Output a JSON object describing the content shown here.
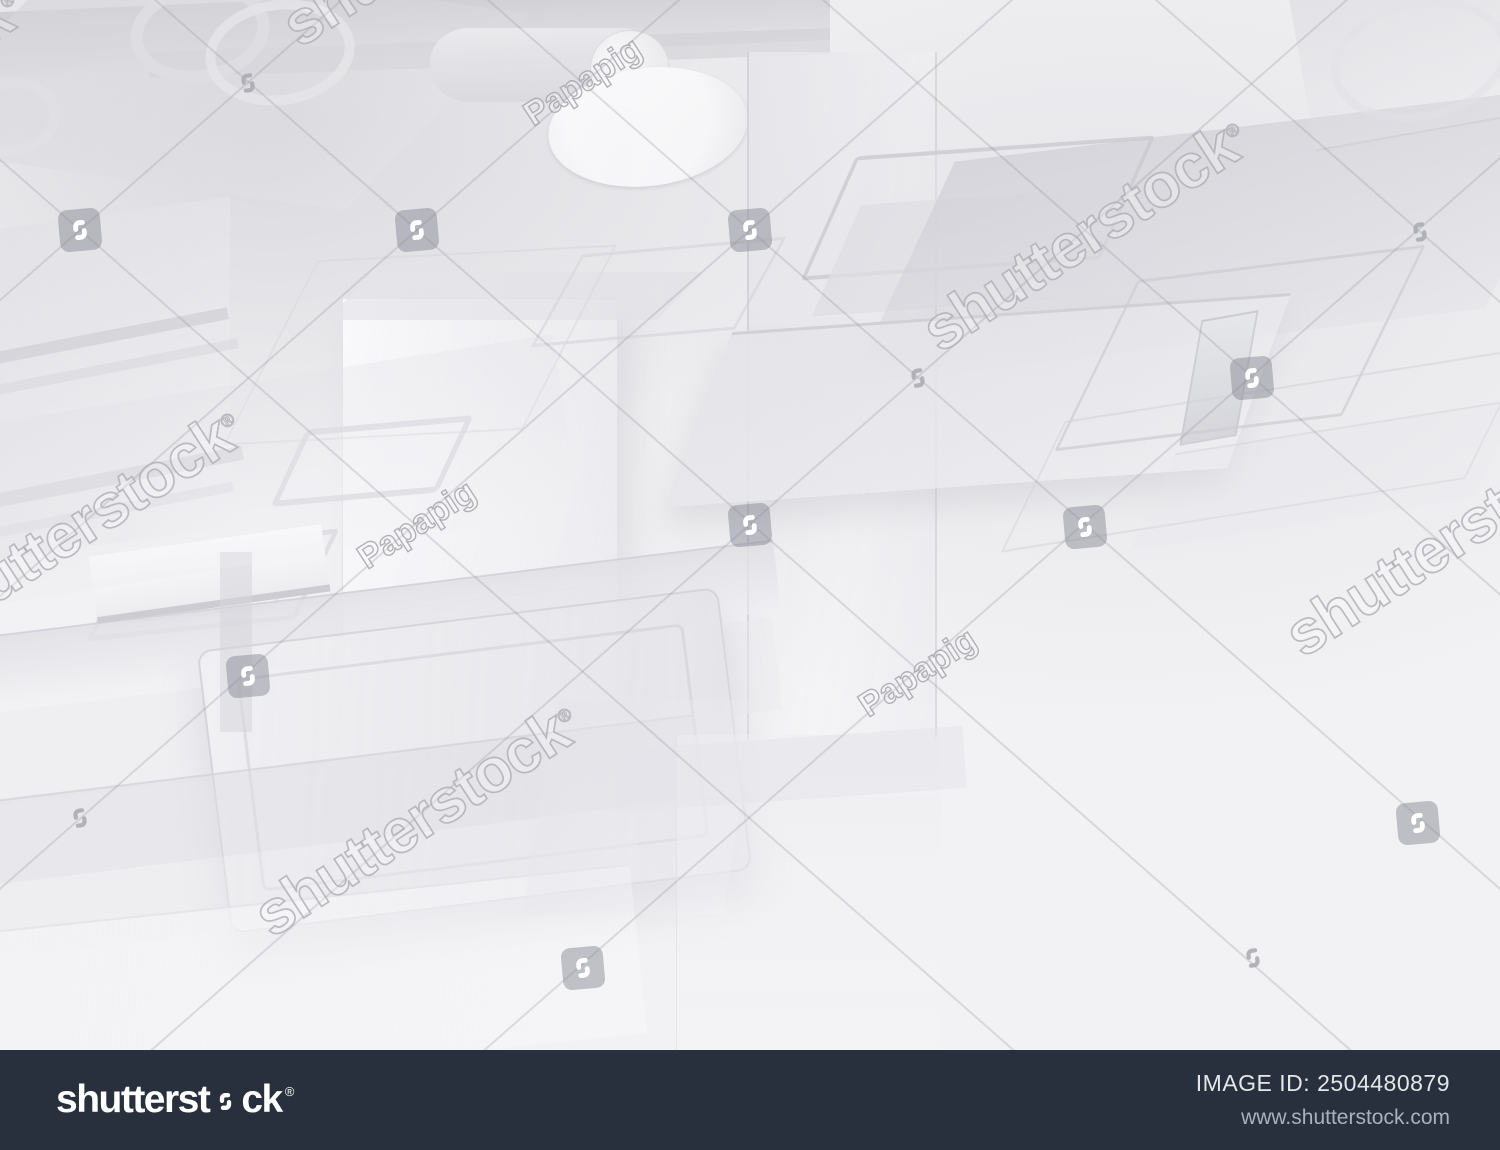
{
  "image": {
    "width": 1500,
    "height": 1150,
    "background_color": "#f2f2f4"
  },
  "watermark": {
    "brand_text": "shutterstock",
    "registered_mark": "®",
    "contributor": "Papapig",
    "text_angle_deg": -33,
    "line_angle_deg": 41.3,
    "colors": {
      "text_outline": "rgba(172,172,180,0.8)",
      "badge_background": "rgba(134,136,146,0.48)",
      "badge_glyph": "#ffffff",
      "glyph_outline": "rgba(168,168,176,0.85)",
      "lattice_line": "rgba(140,140,150,0.26)"
    },
    "brand_texts": [
      {
        "x": -140,
        "y": 105
      },
      {
        "x": 445,
        "y": -70
      },
      {
        "x": 1085,
        "y": 235
      },
      {
        "x": 80,
        "y": 525
      },
      {
        "x": 1448,
        "y": 540
      },
      {
        "x": 417,
        "y": 820
      }
    ],
    "contributor_texts": [
      {
        "x": 583,
        "y": 82
      },
      {
        "x": 417,
        "y": 525
      },
      {
        "x": 918,
        "y": 673
      }
    ],
    "logo_badges": [
      {
        "x": 80,
        "y": 230
      },
      {
        "x": 417,
        "y": 230
      },
      {
        "x": 750,
        "y": 230
      },
      {
        "x": 750,
        "y": 525
      },
      {
        "x": 1085,
        "y": 527
      },
      {
        "x": 1252,
        "y": 378
      },
      {
        "x": 248,
        "y": 676
      },
      {
        "x": 1418,
        "y": 823
      },
      {
        "x": 583,
        "y": 968
      }
    ],
    "logo_glyphs": [
      {
        "x": 248,
        "y": 83
      },
      {
        "x": 1420,
        "y": 232
      },
      {
        "x": 918,
        "y": 378
      },
      {
        "x": 80,
        "y": 818
      },
      {
        "x": 1253,
        "y": 958
      }
    ],
    "lattice_nodes": [
      {
        "x": 80,
        "y": 230
      },
      {
        "x": 417,
        "y": 230
      },
      {
        "x": 750,
        "y": 230
      },
      {
        "x": 1085,
        "y": 230
      },
      {
        "x": 1418,
        "y": 230
      }
    ]
  },
  "footer": {
    "background_color": "#27303c",
    "logo_prefix": "shutterst",
    "logo_suffix": "ck",
    "registered": "®",
    "image_id_line": "IMAGE ID: 2504480879",
    "website_url": "www.shutterstock.com"
  }
}
